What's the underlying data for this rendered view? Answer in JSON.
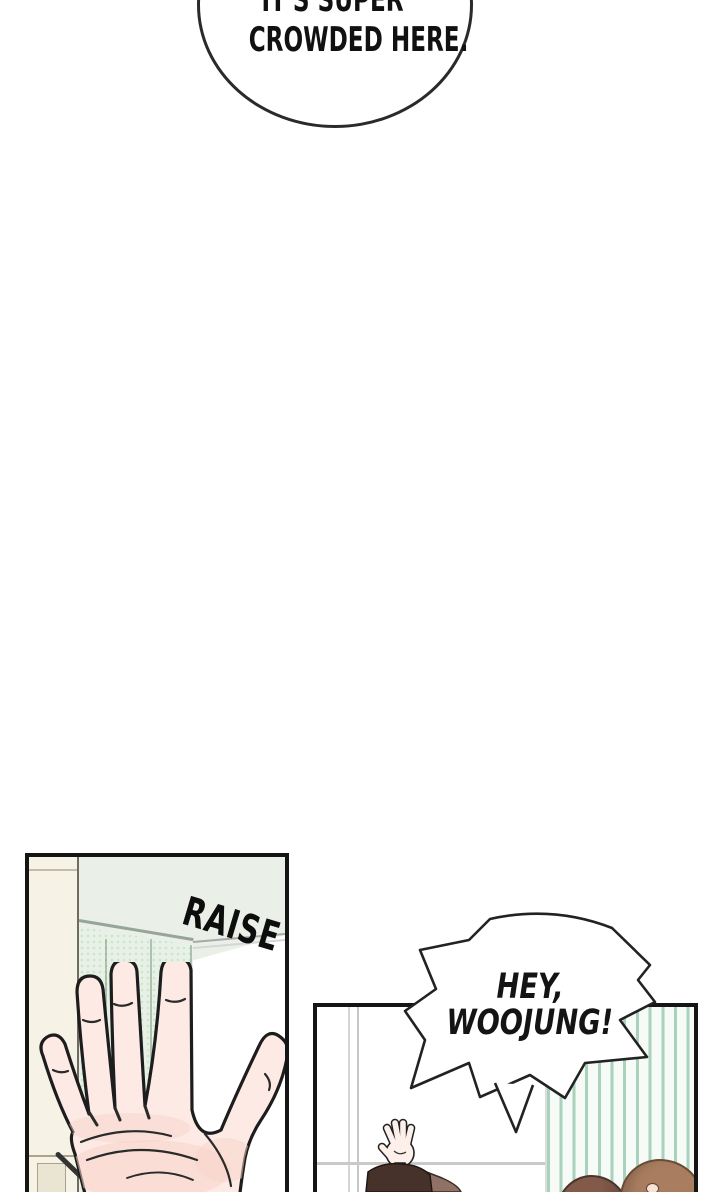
{
  "comic": {
    "top_bubble": {
      "line1": "IT'S SUPER",
      "line2": "CROWDED HERE."
    },
    "shout_bubble": {
      "line1": "HEY,",
      "line2": "WOOJUNG!"
    },
    "sfx_raise": "RAISE"
  },
  "panels": [
    {
      "name": "raise-hand-panel",
      "description": "large open palm raised in front of mint locker wall"
    },
    {
      "name": "greeting-panel",
      "description": "person waving hand by window, two heads in foreground, striped wall"
    }
  ],
  "colors": {
    "page_bg": "#ffffff",
    "ink": "#1d1d1d",
    "skin": "#fdeae4",
    "skin_shade": "#f7d3c9",
    "ceiling_mint": "#eaf0e8",
    "mint_wall": "#e7f1e6",
    "mint_dot": "#cfe3cd",
    "stripe_green": "#a9d2bc",
    "cream_cabinet": "#f6f3e6",
    "sleeve_dark": "#46322b",
    "sleeve_light": "#8f7265",
    "hair_dark": "#6d4c41",
    "hair_light": "#a97e60",
    "window_line": "#c9c9c9"
  }
}
